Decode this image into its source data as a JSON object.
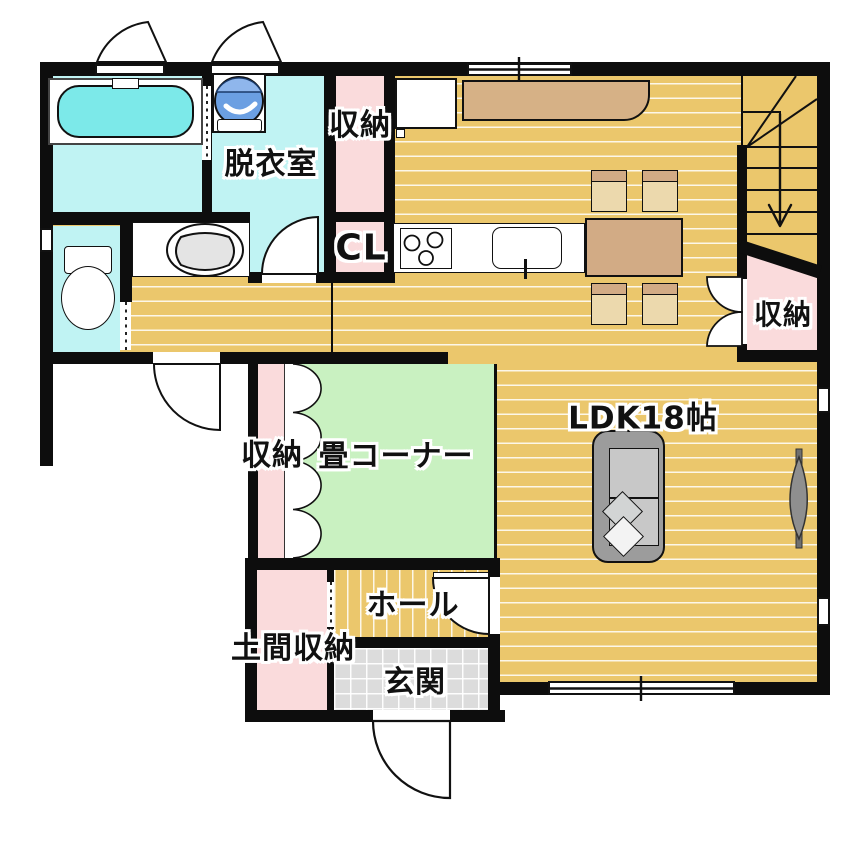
{
  "floor_plan": {
    "labels": {
      "storage_top": "収納",
      "dressing_room": "脱衣室",
      "closet": "CL",
      "stairs_storage": "収納",
      "ldk": "LDK18帖",
      "tatami_storage": "収納",
      "tatami_corner": "畳コーナー",
      "hall": "ホール",
      "doma_storage": "土間収納",
      "entrance": "玄関"
    },
    "colors": {
      "wall": "#0d0d0d",
      "wood_floor": "#ebc76c",
      "tatami_green": "#c9f1c1",
      "storage_pink": "#fadbdc",
      "wet_area_cyan": "#c0f3f3",
      "bathtub_cyan": "#7ce9e9",
      "entrance_tile_gray": "#dcdcdc",
      "furniture_tan": "#d6b186",
      "washer_blue": "#6b9fe2"
    }
  }
}
